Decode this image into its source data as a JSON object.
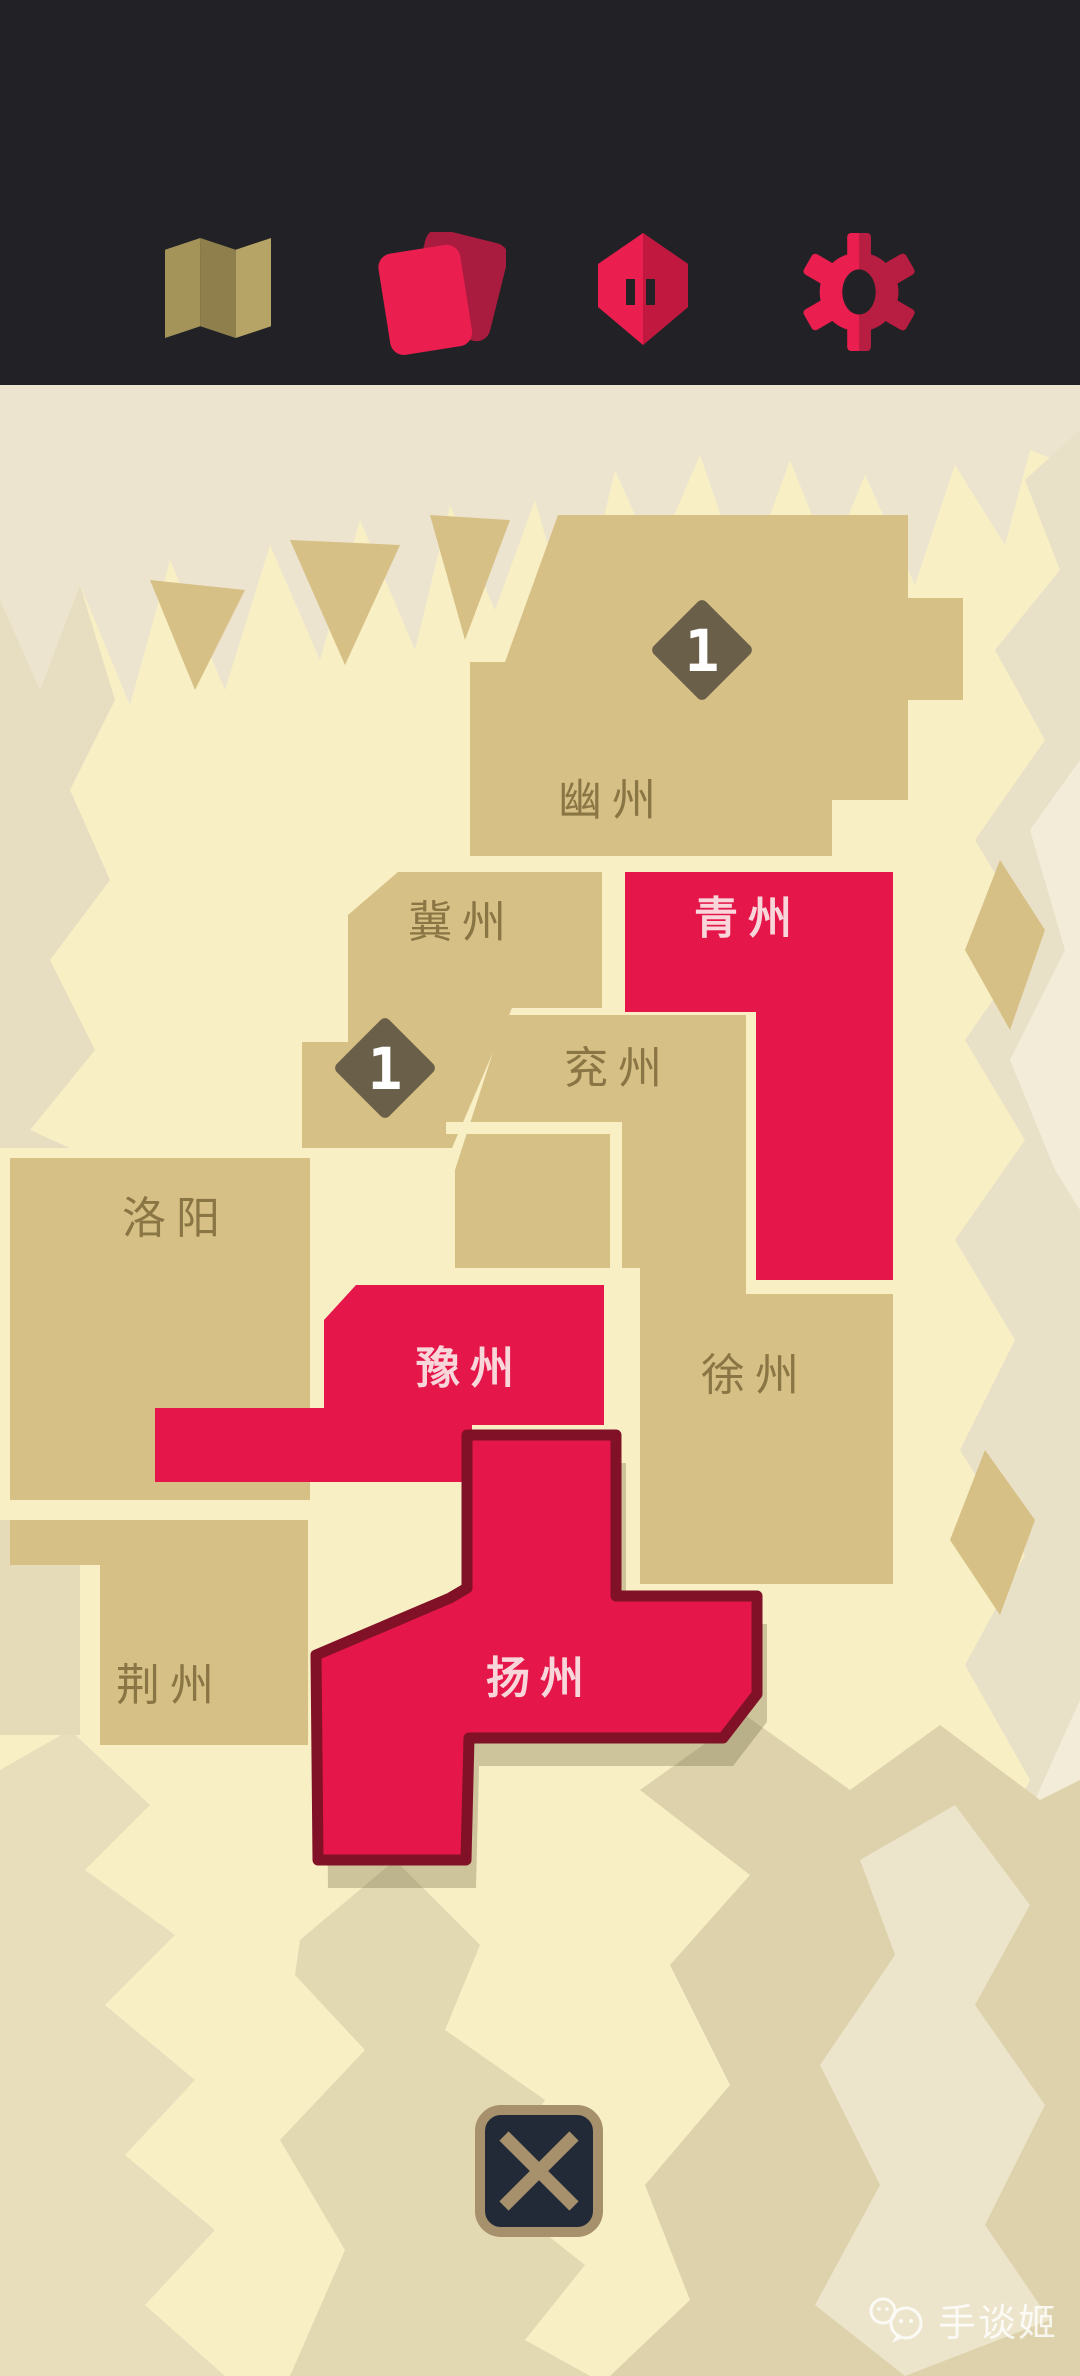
{
  "header": {
    "icons": [
      {
        "name": "map-icon"
      },
      {
        "name": "cards-icon"
      },
      {
        "name": "castle-icon"
      },
      {
        "name": "gear-icon"
      }
    ]
  },
  "map": {
    "regions": [
      {
        "id": "youzhou",
        "label": "幽州",
        "owner": "neutral"
      },
      {
        "id": "jizhou",
        "label": "冀州",
        "owner": "neutral"
      },
      {
        "id": "qingzhou",
        "label": "青州",
        "owner": "player"
      },
      {
        "id": "yanzhou",
        "label": "兖州",
        "owner": "neutral"
      },
      {
        "id": "luoyang",
        "label": "洛阳",
        "owner": "neutral"
      },
      {
        "id": "yuzhou",
        "label": "豫州",
        "owner": "player"
      },
      {
        "id": "xuzhou",
        "label": "徐州",
        "owner": "neutral"
      },
      {
        "id": "jingzhou",
        "label": "荆州",
        "owner": "neutral"
      },
      {
        "id": "yangzhou",
        "label": "扬州",
        "owner": "player",
        "selected": true
      }
    ],
    "badges": [
      {
        "value": "1",
        "location": "youzhou"
      },
      {
        "value": "1",
        "location": "jizhou"
      }
    ]
  },
  "close_button": {
    "glyph": "close-x"
  },
  "watermark": {
    "text": "手谈姬"
  },
  "colors": {
    "toolbar_bg": "#212126",
    "accent_red": "#e5164a",
    "accent_red_dark": "#b51c41",
    "icon_tan": "#a99857",
    "map_background": "#f8efc5",
    "terrain_pale": "#ece4cf",
    "terrain_khaki": "#e2d8b2",
    "region_tan": "#d7c085",
    "region_label_tan": "#8a7544",
    "region_label_red": "#f8d6da",
    "selected_border": "#801126",
    "badge_bg": "#6a6049",
    "close_border": "#a7916c",
    "close_bg": "#232a37"
  }
}
